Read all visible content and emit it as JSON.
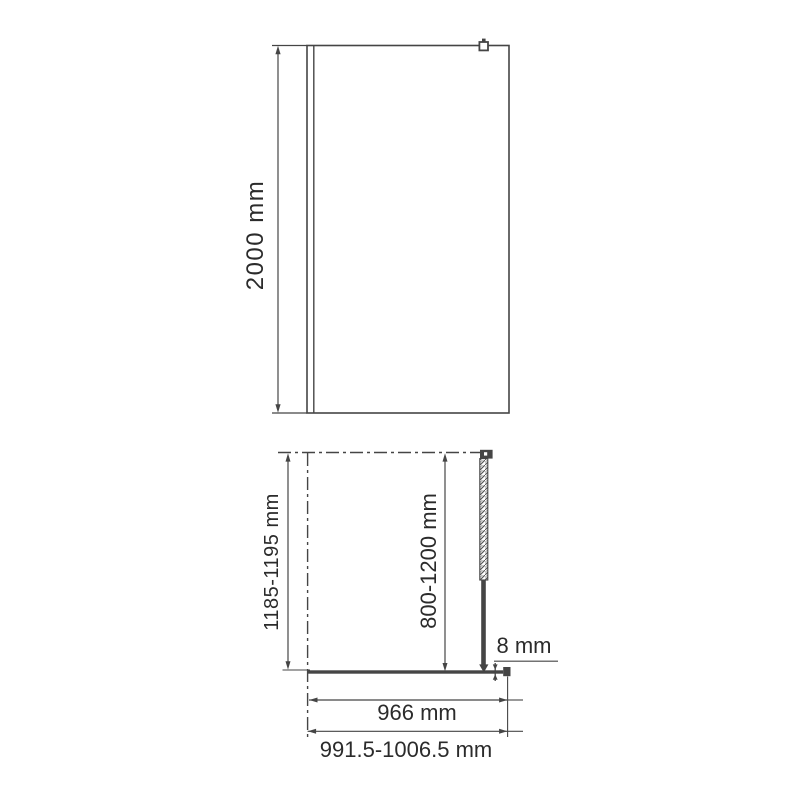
{
  "colors": {
    "line": "#454545",
    "text": "#2b2b2b",
    "background": "#ffffff"
  },
  "front_view": {
    "height_dim": "2000 mm"
  },
  "plan_view": {
    "depth_dim": "1185-1195 mm",
    "support_bar_dim": "800-1200 mm",
    "glass_thickness_dim": "8 mm",
    "glass_width_dim": "966 mm",
    "overall_width_dim": "991.5-1006.5 mm"
  }
}
